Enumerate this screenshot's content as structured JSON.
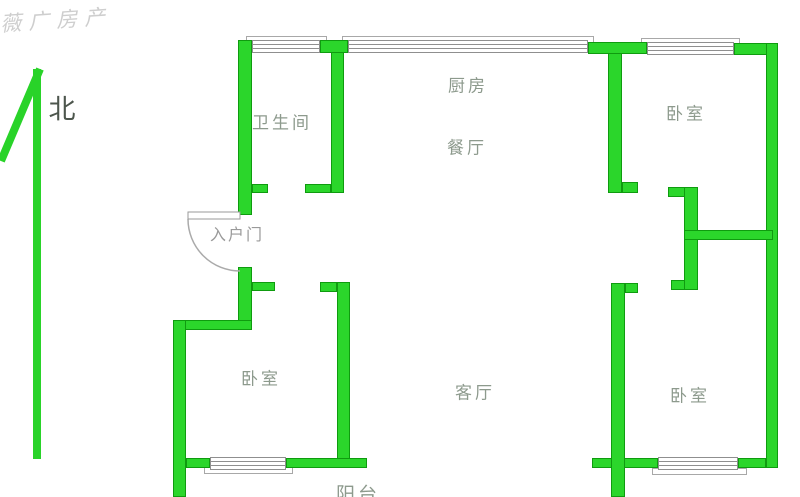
{
  "canvas": {
    "width": 800,
    "height": 497
  },
  "colors": {
    "wall_fill": "#2bd62b",
    "wall_border": "#0f9b0f",
    "room_label": "#8d9a8d",
    "entry_label": "#9a9a9a",
    "north_text": "#4d564d",
    "door_line": "#aaaaaa",
    "window_border": "#8f8f8f",
    "watermark": "#c3c3c3"
  },
  "watermark": {
    "text": "薇广房产"
  },
  "north": {
    "label": "北",
    "x": 62,
    "y": 107
  },
  "rooms": [
    {
      "id": "bathroom",
      "label": "卫生间",
      "x": 282,
      "y": 121,
      "class": ""
    },
    {
      "id": "kitchen",
      "label": "厨房",
      "x": 468,
      "y": 84,
      "class": ""
    },
    {
      "id": "dining",
      "label": "餐厅",
      "x": 467,
      "y": 146,
      "class": ""
    },
    {
      "id": "bedroom-tr",
      "label": "卧室",
      "x": 686,
      "y": 112,
      "class": ""
    },
    {
      "id": "bedroom-bl",
      "label": "卧室",
      "x": 261,
      "y": 377,
      "class": ""
    },
    {
      "id": "living",
      "label": "客厅",
      "x": 475,
      "y": 391,
      "class": ""
    },
    {
      "id": "bedroom-br",
      "label": "卧室",
      "x": 690,
      "y": 394,
      "class": ""
    },
    {
      "id": "balcony",
      "label": "阳台",
      "x": 358,
      "y": 493,
      "class": "balcony-label"
    },
    {
      "id": "entry-door",
      "label": "入户门",
      "x": 237,
      "y": 233,
      "class": "entry-label"
    }
  ],
  "walls": [
    [
      238,
      40,
      14,
      175
    ],
    [
      320,
      40,
      28,
      13
    ],
    [
      588,
      42,
      59,
      12
    ],
    [
      734,
      43,
      44,
      12
    ],
    [
      766,
      43,
      12,
      425
    ],
    [
      331,
      52,
      13,
      141
    ],
    [
      252,
      184,
      16,
      9
    ],
    [
      305,
      184,
      26,
      9
    ],
    [
      608,
      53,
      14,
      140
    ],
    [
      622,
      182,
      16,
      11
    ],
    [
      668,
      187,
      17,
      10
    ],
    [
      684,
      187,
      14,
      103
    ],
    [
      671,
      280,
      14,
      10
    ],
    [
      684,
      230,
      89,
      10
    ],
    [
      238,
      267,
      14,
      63
    ],
    [
      252,
      282,
      23,
      9
    ],
    [
      173,
      320,
      79,
      10
    ],
    [
      173,
      320,
      13,
      177
    ],
    [
      320,
      282,
      17,
      10
    ],
    [
      337,
      282,
      13,
      186
    ],
    [
      286,
      458,
      81,
      10
    ],
    [
      186,
      458,
      24,
      10
    ],
    [
      592,
      458,
      66,
      10
    ],
    [
      738,
      458,
      28,
      10
    ],
    [
      611,
      283,
      14,
      214
    ],
    [
      625,
      283,
      13,
      10
    ]
  ],
  "sills": [
    [
      246,
      36,
      81,
      7
    ],
    [
      342,
      36,
      252,
      7
    ],
    [
      641,
      38,
      99,
      7
    ],
    [
      204,
      467,
      89,
      7
    ],
    [
      652,
      468,
      95,
      7
    ]
  ],
  "windows": [
    [
      252,
      40,
      68,
      13
    ],
    [
      348,
      40,
      240,
      13
    ],
    [
      647,
      42,
      87,
      13
    ],
    [
      210,
      457,
      76,
      13
    ],
    [
      658,
      457,
      80,
      13
    ]
  ],
  "door": {
    "leaf": [
      188,
      212,
      52,
      7
    ],
    "arc_path": "M 188 219 A 52 52 0 0 0 240 271"
  },
  "north_arrow": {
    "diagonal": [
      40,
      69,
      1,
      161
    ],
    "vertical": [
      37,
      69,
      37,
      459
    ]
  }
}
